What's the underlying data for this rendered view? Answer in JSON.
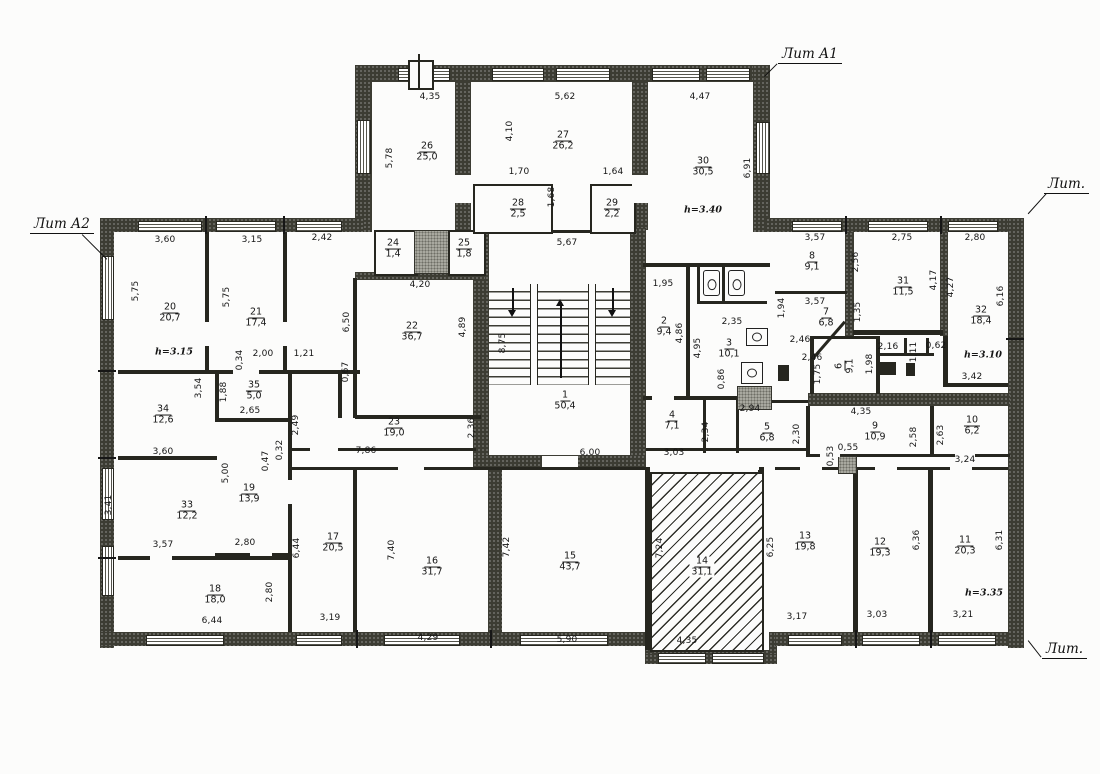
{
  "labels": {
    "lit_a1": "Лит А1",
    "lit_a2": "Лит А2",
    "lit_top_right": "Лит.",
    "lit_bottom_right": "Лит."
  },
  "rooms": [
    {
      "n": "1",
      "a": "50,4"
    },
    {
      "n": "2",
      "a": "9,4"
    },
    {
      "n": "3",
      "a": "10,1"
    },
    {
      "n": "4",
      "a": "7,1"
    },
    {
      "n": "5",
      "a": "6,8"
    },
    {
      "n": "6",
      "a": "9,1"
    },
    {
      "n": "7",
      "a": "6,8"
    },
    {
      "n": "8",
      "a": "9,1"
    },
    {
      "n": "9",
      "a": "10,9"
    },
    {
      "n": "10",
      "a": "6,2"
    },
    {
      "n": "11",
      "a": "20,3"
    },
    {
      "n": "12",
      "a": "19,3"
    },
    {
      "n": "13",
      "a": "19,8"
    },
    {
      "n": "14",
      "a": "31,1"
    },
    {
      "n": "15",
      "a": "43,7"
    },
    {
      "n": "16",
      "a": "31,7"
    },
    {
      "n": "17",
      "a": "20,5"
    },
    {
      "n": "18",
      "a": "18,0"
    },
    {
      "n": "19",
      "a": "13,9"
    },
    {
      "n": "20",
      "a": "20,7"
    },
    {
      "n": "21",
      "a": "17,4"
    },
    {
      "n": "22",
      "a": "36,7"
    },
    {
      "n": "23",
      "a": "19,0"
    },
    {
      "n": "24",
      "a": "1,4"
    },
    {
      "n": "25",
      "a": "1,8"
    },
    {
      "n": "26",
      "a": "25,0"
    },
    {
      "n": "27",
      "a": "26,2"
    },
    {
      "n": "28",
      "a": "2,5"
    },
    {
      "n": "29",
      "a": "2,2"
    },
    {
      "n": "30",
      "a": "30,5"
    },
    {
      "n": "31",
      "a": "11,5"
    },
    {
      "n": "32",
      "a": "18,4"
    },
    {
      "n": "33",
      "a": "12,2"
    },
    {
      "n": "34",
      "a": "12,6"
    },
    {
      "n": "35",
      "a": "5,0"
    }
  ],
  "heights": {
    "r20": "h=3.15",
    "r30": "h=3.40",
    "r32": "h=3.10",
    "r11": "h=3.35"
  },
  "dims": [
    "4,35",
    "5,62",
    "4,47",
    "5,78",
    "4,10",
    "6,91",
    "1,70",
    "1,64",
    "1,68",
    "5,67",
    "3,60",
    "3,15",
    "2,42",
    "5,75",
    "5,75",
    "6,50",
    "4,20",
    "4,89",
    "8,75",
    "1,95",
    "4,86",
    "4,95",
    "2,35",
    "0,86",
    "2,94",
    "2,34",
    "2,30",
    "6,00",
    "3,03",
    "0,34",
    "2,00",
    "1,21",
    "0,67",
    "1,88",
    "3,54",
    "2,65",
    "2,49",
    "3,60",
    "5,00",
    "0,47",
    "0,32",
    "3,41",
    "3,57",
    "2,80",
    "6,44",
    "6,44",
    "2,80",
    "3,19",
    "7,40",
    "4,29",
    "7,42",
    "5,90",
    "7,24",
    "4,35",
    "6,25",
    "3,17",
    "0,55",
    "0,53",
    "6,36",
    "3,03",
    "6,31",
    "3,21",
    "3,57",
    "2,75",
    "2,80",
    "2,56",
    "1,94",
    "3,57",
    "1,35",
    "2,46",
    "2,46",
    "1,75",
    "1,98",
    "2,16",
    "1,11",
    "0,62",
    "4,17",
    "4,27",
    "6,16",
    "3,42",
    "4,35",
    "2,58",
    "2,63",
    "3,24",
    "2,36",
    "7,86"
  ]
}
